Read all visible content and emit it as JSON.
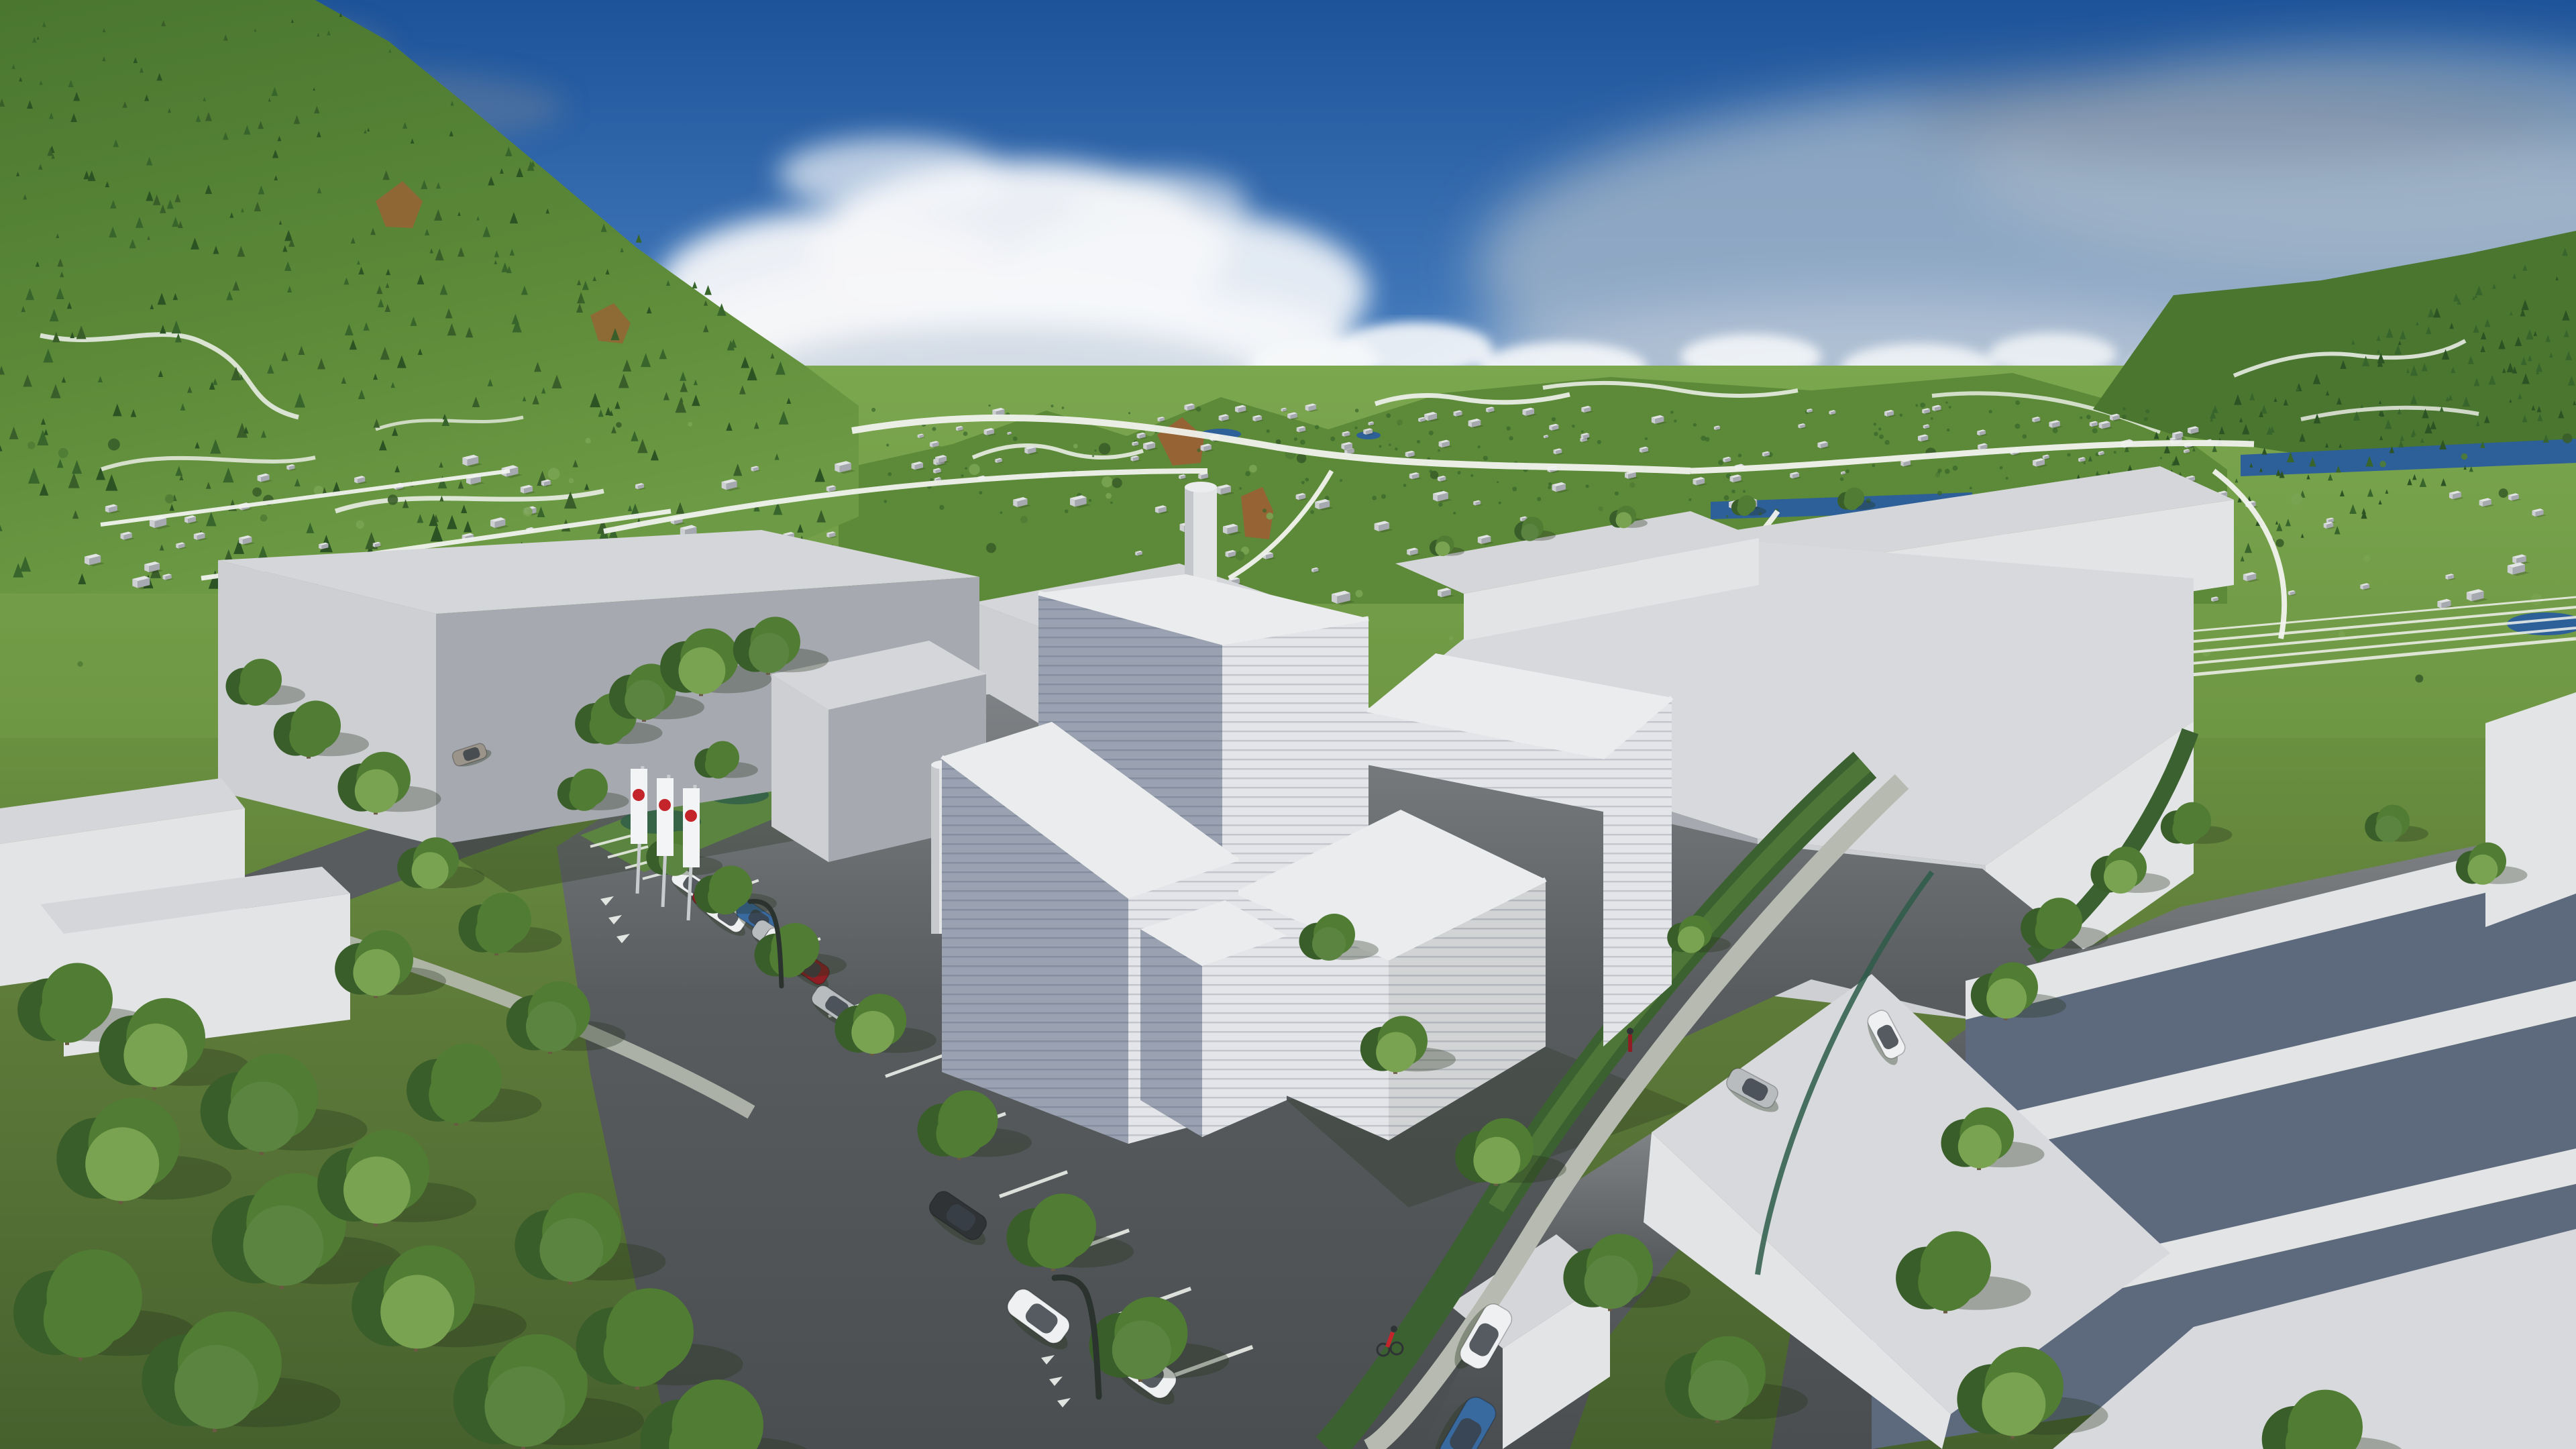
{
  "scene": {
    "type": "aerial-3d-architectural-rendering",
    "setting": "alpine-valley-town-massing-model",
    "flags": {
      "count": 3,
      "banner": "white",
      "logo": "red-dot"
    },
    "street_lamps": 2,
    "figures": [
      "cyclist",
      "pedestrian"
    ],
    "vehicles": [
      "white",
      "red",
      "white",
      "blue",
      "silver",
      "white",
      "red",
      "silver",
      "dark",
      "white",
      "white",
      "white",
      "blue",
      "silver",
      "white",
      "tan"
    ]
  },
  "palette": {
    "sky_top": "#1d5399",
    "sky_mid": "#3f76b8",
    "sky_low": "#8fb0d3",
    "sky_horizon": "#cfdbe6",
    "cloud_white": "#f5f7f9",
    "cloud_shade": "#c6d2de",
    "cloud_haze": "#a9bac9",
    "cloud_dark": "#6e8098",
    "hill_far": "#6d9a44",
    "hill_mid": "#5c8a38",
    "hill_dark": "#4a7630",
    "forest_dark": "#2c5323",
    "forest_mid": "#38652b",
    "cliff_brown": "#966434",
    "field_far": "#7ba74f",
    "field_near": "#69903f",
    "grass_fg": "#5f7c3a",
    "grass_dark": "#47612e",
    "trail_white": "#f1f3ee",
    "gravel": "#b6bab0",
    "asphalt": "#585c5e",
    "asphalt_far": "#7e8285",
    "asphalt_dark": "#4a4e50",
    "box_lit": "#e3e4e6",
    "box_front": "#cdcfd3",
    "box_shade": "#a6a9af",
    "box_roof": "#d5d6d9",
    "slab_face_blue": "#5d6a7d",
    "louver_lit": "#e4e5e8",
    "louver_lit_line": "#c3c7cd",
    "louver_shade": "#9aa2b1",
    "louver_shade_line": "#848e9f",
    "roof_white": "#ebecee",
    "roof_pale": "#d8d9dc",
    "glass_blue": "#7c8ba1",
    "river": "#2d5f98",
    "stream_teal": "#2e5c49",
    "hedge": "#3c6130",
    "hedge_light": "#5b8440",
    "tree_light": "#79a351",
    "tree_mid": "#507c34",
    "tree_dark": "#3a5e2a",
    "trunk": "#6b5a42",
    "flag_white": "#f3f4f5",
    "flag_red": "#c4252b",
    "pole": "#c9ccce",
    "lamp_dark": "#2b332f",
    "car_white": "#eef0f1",
    "car_red": "#8e1e23",
    "car_blue": "#38699f",
    "car_silver": "#b8bcbf",
    "car_dark": "#2f3336",
    "car_tan": "#9a948a",
    "glass": "#3a4148",
    "shadow": "#26331d"
  }
}
